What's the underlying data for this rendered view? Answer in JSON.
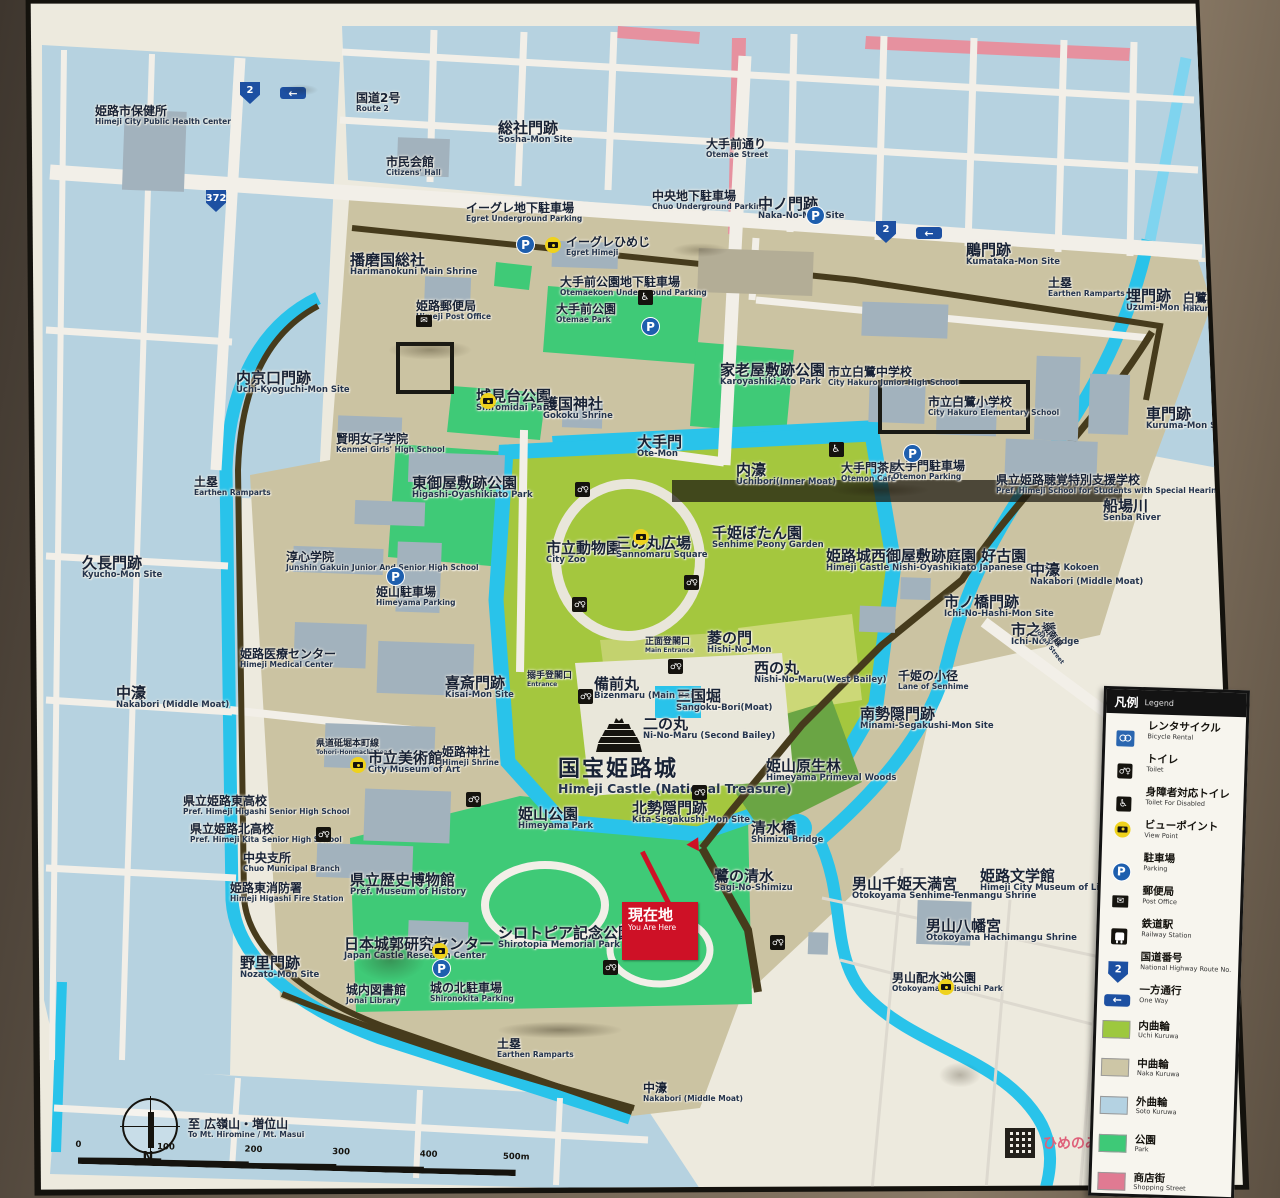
{
  "sign": {
    "title_note": "Himeji Castle area guide map sign",
    "you_are_here": {
      "jp": "現在地",
      "en": "You Are Here"
    },
    "compass_n": "N",
    "logo_text": "ひめのみち",
    "scale": {
      "ticks": [
        "0",
        "100",
        "200",
        "300",
        "400",
        "500m"
      ]
    },
    "legend": {
      "header_jp": "凡例",
      "header_en": "Legend",
      "symbols": [
        {
          "type": "bicycle",
          "jp": "レンタサイクル",
          "en": "Bicycle Rental"
        },
        {
          "type": "toilet",
          "jp": "トイレ",
          "en": "Toilet"
        },
        {
          "type": "wheelchair",
          "jp": "身障者対応トイレ",
          "en": "Toilet For Disabled"
        },
        {
          "type": "camera",
          "jp": "ビューポイント",
          "en": "View Point"
        },
        {
          "type": "parking",
          "jp": "駐車場",
          "en": "Parking"
        },
        {
          "type": "post",
          "jp": "郵便局",
          "en": "Post Office"
        },
        {
          "type": "train",
          "jp": "鉄道駅",
          "en": "Railway Station"
        },
        {
          "type": "shield",
          "label": "2",
          "jp": "国道番号",
          "en": "National Highway Route No."
        },
        {
          "type": "oneway",
          "jp": "一方通行",
          "en": "One Way"
        }
      ],
      "areas": [
        {
          "color": "#9dc83e",
          "jp": "内曲輪",
          "en": "Uchi Kuruwa"
        },
        {
          "color": "#cdc6a6",
          "jp": "中曲輪",
          "en": "Naka Kuruwa"
        },
        {
          "color": "#b4d2e2",
          "jp": "外曲輪",
          "en": "Soto Kuruwa"
        },
        {
          "color": "#3ec977",
          "jp": "公園",
          "en": "Park"
        },
        {
          "color": "#e07a92",
          "jp": "商店街",
          "en": "Shopping Street"
        }
      ]
    },
    "icon_glyphs": {
      "parking": "P",
      "oneway": "←",
      "post": "✉",
      "toilet": "♂♀",
      "wheelchair": "♿"
    },
    "map": {
      "labels": [
        {
          "id": "himeji-health-center",
          "jp": "姫路市保健所",
          "en": "Himeji City Public Health Center",
          "x": 95,
          "y": 105
        },
        {
          "id": "route2-top",
          "jp": "国道2号",
          "en": "Route 2",
          "x": 356,
          "y": 92
        },
        {
          "id": "sosha-mon",
          "jp": "総社門跡",
          "en": "Sosha-Mon Site",
          "x": 498,
          "y": 120,
          "s": "lg"
        },
        {
          "id": "citizens-hall",
          "jp": "市民会館",
          "en": "Citizens' Hall",
          "x": 386,
          "y": 156
        },
        {
          "id": "otemae-street",
          "jp": "大手前通り",
          "en": "Otemae Street",
          "x": 706,
          "y": 138
        },
        {
          "id": "chuo-parking",
          "jp": "中央地下駐車場",
          "en": "Chuo Underground Parking",
          "x": 652,
          "y": 190
        },
        {
          "id": "naka-no-mon",
          "jp": "中ノ門跡",
          "en": "Naka-No-Mon Site",
          "x": 758,
          "y": 196,
          "s": "lg"
        },
        {
          "id": "kumataka-mon",
          "jp": "鵰門跡",
          "en": "Kumataka-Mon Site",
          "x": 966,
          "y": 242,
          "s": "lg"
        },
        {
          "id": "ramparts-ne",
          "jp": "土塁",
          "en": "Earthen Ramparts",
          "x": 1048,
          "y": 277
        },
        {
          "id": "uzumi-mon",
          "jp": "埋門跡",
          "en": "Uzumi-Mon Site",
          "x": 1126,
          "y": 288,
          "s": "lg"
        },
        {
          "id": "hakuro-bridge",
          "jp": "白鷺橋",
          "en": "Hakuro Bridge",
          "x": 1183,
          "y": 292
        },
        {
          "id": "harimanokuni",
          "jp": "播磨国総社",
          "en": "Harimanokuni Main Shrine",
          "x": 350,
          "y": 252,
          "s": "lg"
        },
        {
          "id": "egret-parking",
          "jp": "イーグレ地下駐車場",
          "en": "Egret Underground Parking",
          "x": 466,
          "y": 202
        },
        {
          "id": "egret-himeji",
          "jp": "イーグレひめじ",
          "en": "Egret Himeji",
          "x": 566,
          "y": 236
        },
        {
          "id": "himeji-post-office",
          "jp": "姫路郵便局",
          "en": "Himeji Post Office",
          "x": 416,
          "y": 300
        },
        {
          "id": "otemaekoen-parking",
          "jp": "大手前公園地下駐車場",
          "en": "Otemaekoen Underground Parking",
          "x": 560,
          "y": 276
        },
        {
          "id": "otemae-park",
          "jp": "大手前公園",
          "en": "Otemae Park",
          "x": 556,
          "y": 303
        },
        {
          "id": "karoyashiki-park",
          "jp": "家老屋敷跡公園",
          "en": "Karoyashiki-Ato Park",
          "x": 720,
          "y": 362,
          "s": "lg"
        },
        {
          "id": "hakuro-jhs",
          "jp": "市立白鷺中学校",
          "en": "City Hakuro Junior High School",
          "x": 828,
          "y": 366
        },
        {
          "id": "hakuro-es",
          "jp": "市立白鷺小学校",
          "en": "City Hakuro Elementary School",
          "x": 928,
          "y": 396
        },
        {
          "id": "kuruma-mon",
          "jp": "車門跡",
          "en": "Kuruma-Mon Site",
          "x": 1146,
          "y": 406,
          "s": "lg"
        },
        {
          "id": "uchi-kyoguchi-mon",
          "jp": "内京口門跡",
          "en": "Uchi-Kyoguchi-Mon Site",
          "x": 236,
          "y": 370,
          "s": "lg"
        },
        {
          "id": "kenmei",
          "jp": "賢明女子学院",
          "en": "Kenmei Girls' High School",
          "x": 336,
          "y": 433
        },
        {
          "id": "shiromidai-park",
          "jp": "城見台公園",
          "en": "Shiromidai Park",
          "x": 476,
          "y": 388,
          "s": "lg"
        },
        {
          "id": "gokoku-shrine",
          "jp": "護国神社",
          "en": "Gokoku Shrine",
          "x": 543,
          "y": 396,
          "s": "lg"
        },
        {
          "id": "ote-mon",
          "jp": "大手門",
          "en": "Ote-Mon",
          "x": 637,
          "y": 434,
          "s": "lg"
        },
        {
          "id": "uchibori",
          "jp": "内濠",
          "en": "Uchibori(Inner Moat)",
          "x": 736,
          "y": 462,
          "s": "lg"
        },
        {
          "id": "otemon-cafe",
          "jp": "大手門茶屋",
          "en": "Otemon Cafe",
          "x": 841,
          "y": 462
        },
        {
          "id": "otemon-parking",
          "jp": "大手門駐車場",
          "en": "Otemon Parking",
          "x": 893,
          "y": 460
        },
        {
          "id": "hearing-school",
          "jp": "県立姫路聴覚特別支援学校",
          "en": "Pref. Himeji School for Students with Special Hearing Needs",
          "x": 996,
          "y": 474
        },
        {
          "id": "senba-river",
          "jp": "船場川",
          "en": "Senba River",
          "x": 1103,
          "y": 498,
          "s": "lg"
        },
        {
          "id": "ramparts-w",
          "jp": "土塁",
          "en": "Earthen Ramparts",
          "x": 194,
          "y": 476
        },
        {
          "id": "higashi-oyashikiato",
          "jp": "東御屋敷跡公園",
          "en": "Higashi-Oyashikiato Park",
          "x": 412,
          "y": 475,
          "s": "lg"
        },
        {
          "id": "kyucho-mon",
          "jp": "久長門跡",
          "en": "Kyucho-Mon Site",
          "x": 82,
          "y": 555,
          "s": "lg"
        },
        {
          "id": "junshin",
          "jp": "淳心学院",
          "en": "Junshin Gakuin Junior And Senior High School",
          "x": 286,
          "y": 551
        },
        {
          "id": "city-zoo",
          "jp": "市立動物園",
          "en": "City Zoo",
          "x": 546,
          "y": 540,
          "s": "lg"
        },
        {
          "id": "sannomaru",
          "jp": "三の丸広場",
          "en": "Sannomaru Square",
          "x": 616,
          "y": 535,
          "s": "lg"
        },
        {
          "id": "senhime-peony",
          "jp": "千姫ぼたん園",
          "en": "Senhime Peony Garden",
          "x": 712,
          "y": 525,
          "s": "lg"
        },
        {
          "id": "kokoen",
          "jp": "姫路城西御屋敷跡庭園 好古園",
          "en": "Himeji Castle Nishi-Oyashikiato Japanese Garden Kokoen",
          "x": 826,
          "y": 548,
          "s": "lg"
        },
        {
          "id": "nakabori-e",
          "jp": "中濠",
          "en": "Nakabori (Middle Moat)",
          "x": 1030,
          "y": 562,
          "s": "lg"
        },
        {
          "id": "ichinohashi-mon",
          "jp": "市ノ橋門跡",
          "en": "Ichi-No-Hashi-Mon Site",
          "x": 944,
          "y": 594,
          "s": "lg"
        },
        {
          "id": "ichino-bridge",
          "jp": "市之橋",
          "en": "Ichi-No Bridge",
          "x": 1011,
          "y": 622,
          "s": "lg"
        },
        {
          "id": "himeyama-parking",
          "jp": "姫山駐車場",
          "en": "Himeyama Parking",
          "x": 376,
          "y": 586
        },
        {
          "id": "main-entrance",
          "jp": "正面登閣口",
          "en": "Main Entrance",
          "x": 645,
          "y": 638,
          "s": "sm"
        },
        {
          "id": "hishi-no-mon",
          "jp": "菱の門",
          "en": "Hishi-No-Mon",
          "x": 707,
          "y": 630,
          "s": "lg"
        },
        {
          "id": "nishi-no-maru",
          "jp": "西の丸",
          "en": "Nishi-No-Maru(West Bailey)",
          "x": 754,
          "y": 660,
          "s": "lg"
        },
        {
          "id": "kisai-mon",
          "jp": "喜斎門跡",
          "en": "Kisai-Mon Site",
          "x": 445,
          "y": 675,
          "s": "lg"
        },
        {
          "id": "karamete-entrance",
          "jp": "搦手登閣口",
          "en": "Entrance",
          "x": 527,
          "y": 672,
          "s": "sm"
        },
        {
          "id": "bizenmaru",
          "jp": "備前丸",
          "en": "Bizenmaru (Main Bailey)",
          "x": 594,
          "y": 676,
          "s": "lg"
        },
        {
          "id": "sangoku-bori",
          "jp": "三国堀",
          "en": "Sangoku-Bori(Moat)",
          "x": 676,
          "y": 688,
          "s": "lg"
        },
        {
          "id": "senhime-lane",
          "jp": "千姫の小径",
          "en": "Lane of Senhime",
          "x": 898,
          "y": 670
        },
        {
          "id": "minami-segakushi",
          "jp": "南勢隠門跡",
          "en": "Minami-Segakushi-Mon Site",
          "x": 860,
          "y": 706,
          "s": "lg"
        },
        {
          "id": "himeji-medical",
          "jp": "姫路医療センター",
          "en": "Himeji Medical Center",
          "x": 240,
          "y": 648
        },
        {
          "id": "nakabori-w",
          "jp": "中濠",
          "en": "Nakabori (Middle Moat)",
          "x": 116,
          "y": 685,
          "s": "lg"
        },
        {
          "id": "ni-no-maru",
          "jp": "二の丸",
          "en": "Ni-No-Maru (Second Bailey)",
          "x": 643,
          "y": 716,
          "s": "lg"
        },
        {
          "id": "tohori-road",
          "jp": "県道砥堀本町線",
          "en": "Tohori-Honmachi Road",
          "x": 316,
          "y": 740,
          "s": "sm"
        },
        {
          "id": "city-museum-art",
          "jp": "市立美術館",
          "en": "City Museum of Art",
          "x": 368,
          "y": 750,
          "s": "lg"
        },
        {
          "id": "himeji-shrine",
          "jp": "姫路神社",
          "en": "Himeji Shrine",
          "x": 442,
          "y": 746
        },
        {
          "id": "himeji-castle",
          "jp": "国宝姫路城",
          "en": "Himeji Castle (National Treasure)",
          "x": 558,
          "y": 758,
          "s": "xl"
        },
        {
          "id": "himeyama-woods",
          "jp": "姫山原生林",
          "en": "Himeyama Primeval Woods",
          "x": 766,
          "y": 758,
          "s": "lg"
        },
        {
          "id": "himeji-higashi-hs",
          "jp": "県立姫路東高校",
          "en": "Pref. Himeji Higashi Senior High School",
          "x": 183,
          "y": 795
        },
        {
          "id": "himeji-kita-hs",
          "jp": "県立姫路北高校",
          "en": "Pref. Himeji Kita Senior High School",
          "x": 190,
          "y": 823
        },
        {
          "id": "chuo-branch",
          "jp": "中央支所",
          "en": "Chuo Municipal Branch",
          "x": 243,
          "y": 852
        },
        {
          "id": "fire-station",
          "jp": "姫路東消防署",
          "en": "Himeji Higashi Fire Station",
          "x": 230,
          "y": 882
        },
        {
          "id": "himeyama-park",
          "jp": "姫山公園",
          "en": "Himeyama Park",
          "x": 518,
          "y": 806,
          "s": "lg"
        },
        {
          "id": "kita-segakushi",
          "jp": "北勢隠門跡",
          "en": "Kita-Segakushi-Mon Site",
          "x": 632,
          "y": 800,
          "s": "lg"
        },
        {
          "id": "shimizu-bridge",
          "jp": "清水橋",
          "en": "Shimizu Bridge",
          "x": 751,
          "y": 820,
          "s": "lg"
        },
        {
          "id": "sagi-no-shimizu",
          "jp": "鷺の清水",
          "en": "Sagi-No-Shimizu",
          "x": 714,
          "y": 868,
          "s": "lg"
        },
        {
          "id": "pref-museum-history",
          "jp": "県立歴史博物館",
          "en": "Pref. Museum of History",
          "x": 350,
          "y": 872,
          "s": "lg"
        },
        {
          "id": "shirotopia",
          "jp": "シロトピア記念公園",
          "en": "Shirotopia Memorial Park",
          "x": 498,
          "y": 925,
          "s": "lg"
        },
        {
          "id": "castle-research",
          "jp": "日本城郭研究センター",
          "en": "Japan Castle Research Center",
          "x": 344,
          "y": 936,
          "s": "lg"
        },
        {
          "id": "otokoyama-tenmangu",
          "jp": "男山千姫天満宮",
          "en": "Otokoyama Senhime-Tenmangu Shrine",
          "x": 852,
          "y": 876,
          "s": "lg"
        },
        {
          "id": "himeji-lit-museum",
          "jp": "姫路文学館",
          "en": "Himeji City Museum of Literature",
          "x": 980,
          "y": 868,
          "s": "lg"
        },
        {
          "id": "otokoyama-hachimangu",
          "jp": "男山八幡宮",
          "en": "Otokoyama Hachimangu Shrine",
          "x": 926,
          "y": 918,
          "s": "lg"
        },
        {
          "id": "nozato-mon",
          "jp": "野里門跡",
          "en": "Nozato-Mon Site",
          "x": 240,
          "y": 955,
          "s": "lg"
        },
        {
          "id": "jonai-library",
          "jp": "城内図書館",
          "en": "Jonai Library",
          "x": 346,
          "y": 984
        },
        {
          "id": "shironokita-parking",
          "jp": "城の北駐車場",
          "en": "Shironokita Parking",
          "x": 430,
          "y": 982
        },
        {
          "id": "otokoyama-haisuichi",
          "jp": "男山配水池公園",
          "en": "Otokoyama Haisuichi Park",
          "x": 892,
          "y": 972
        },
        {
          "id": "ramparts-s",
          "jp": "土塁",
          "en": "Earthen Ramparts",
          "x": 497,
          "y": 1038
        },
        {
          "id": "nakabori-s",
          "jp": "中濠",
          "en": "Nakabori (Middle Moat)",
          "x": 643,
          "y": 1082
        },
        {
          "id": "jonan-street",
          "jp": "城南線",
          "en": "Jonan Street",
          "x": 1032,
          "y": 636,
          "s": "sm",
          "r": 52
        },
        {
          "id": "to-hiromine",
          "jp": "至 広嶺山・増位山",
          "en": "To Mt. Hiromine / Mt. Masui",
          "x": 188,
          "y": 1118
        }
      ],
      "icons": [
        {
          "type": "shield",
          "label": "2",
          "x": 240,
          "y": 82
        },
        {
          "type": "oneway",
          "x": 280,
          "y": 87
        },
        {
          "type": "shield",
          "label": "372",
          "x": 206,
          "y": 190
        },
        {
          "type": "shield",
          "label": "2",
          "x": 876,
          "y": 221
        },
        {
          "type": "oneway",
          "x": 916,
          "y": 227
        },
        {
          "type": "parking",
          "x": 806,
          "y": 206
        },
        {
          "type": "parking",
          "x": 516,
          "y": 235
        },
        {
          "type": "camera",
          "x": 545,
          "y": 237
        },
        {
          "type": "parking",
          "x": 641,
          "y": 317
        },
        {
          "type": "post",
          "x": 416,
          "y": 315
        },
        {
          "type": "toilet-acc",
          "x": 645,
          "y": 297
        },
        {
          "type": "camera",
          "x": 480,
          "y": 377
        },
        {
          "type": "toilet-acc",
          "x": 836,
          "y": 449
        },
        {
          "type": "parking",
          "x": 903,
          "y": 444
        },
        {
          "type": "toilet",
          "x": 575,
          "y": 482
        },
        {
          "type": "camera",
          "x": 633,
          "y": 497
        },
        {
          "type": "toilet",
          "x": 684,
          "y": 575
        },
        {
          "type": "toilet",
          "x": 572,
          "y": 597
        },
        {
          "type": "parking",
          "x": 386,
          "y": 567
        },
        {
          "type": "toilet",
          "x": 668,
          "y": 659
        },
        {
          "type": "toilet",
          "x": 578,
          "y": 689
        },
        {
          "type": "camera",
          "x": 350,
          "y": 709
        },
        {
          "type": "castle",
          "x": 596,
          "y": 718
        },
        {
          "type": "toilet",
          "x": 692,
          "y": 785
        },
        {
          "type": "toilet",
          "x": 466,
          "y": 792
        },
        {
          "type": "toilet",
          "x": 316,
          "y": 827
        },
        {
          "type": "camera",
          "x": 432,
          "y": 879
        },
        {
          "type": "camera",
          "x": 938,
          "y": 899
        },
        {
          "type": "toilet",
          "x": 770,
          "y": 935
        },
        {
          "type": "toilet",
          "x": 603,
          "y": 960
        },
        {
          "type": "parking",
          "x": 432,
          "y": 959
        }
      ]
    }
  }
}
